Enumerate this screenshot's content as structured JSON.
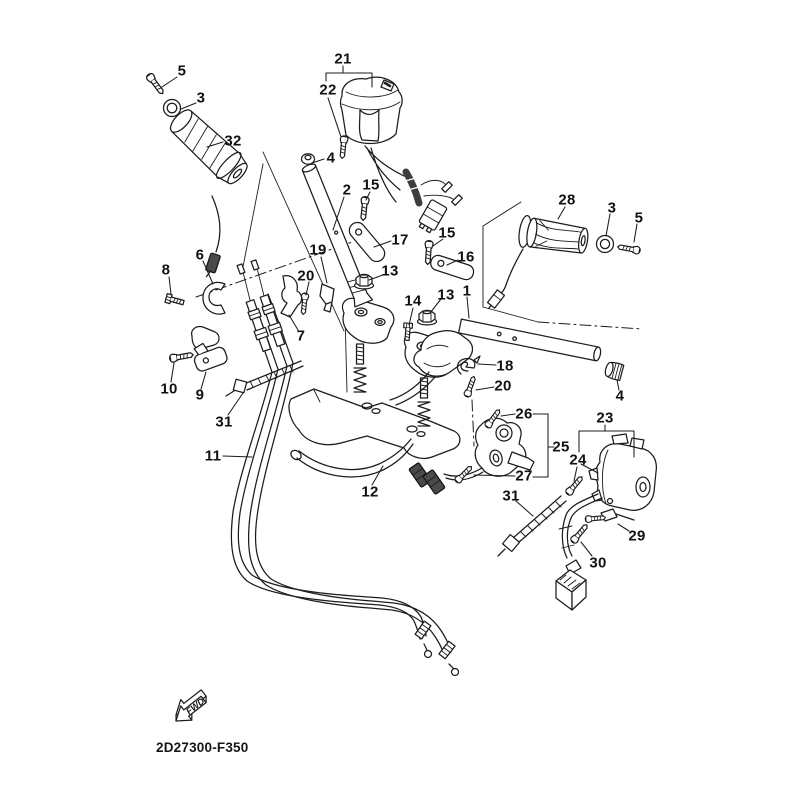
{
  "figure": {
    "diagram_code": "2D27300-F350",
    "fwd_arrow_label": "FWD"
  },
  "colors": {
    "line": "#1c1c1c",
    "background": "#ffffff",
    "connector_fill": "#4a4a4a"
  },
  "callouts": [
    "5",
    "3",
    "32",
    "21",
    "22",
    "4",
    "2",
    "15",
    "17",
    "15",
    "16",
    "19",
    "20",
    "6",
    "8",
    "13",
    "14",
    "13",
    "1",
    "7",
    "10",
    "9",
    "31",
    "11",
    "12",
    "18",
    "20",
    "4",
    "26",
    "25",
    "27",
    "23",
    "24",
    "31",
    "29",
    "30",
    "28",
    "3",
    "5"
  ]
}
